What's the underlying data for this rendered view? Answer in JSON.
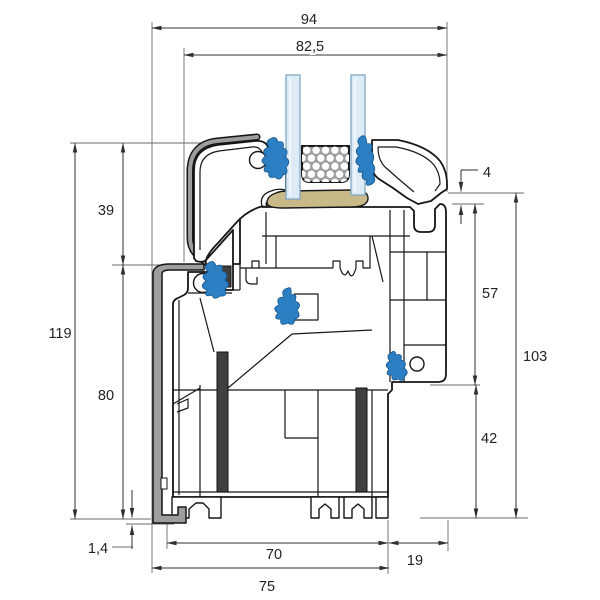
{
  "drawing": {
    "type": "technical-cross-section",
    "subject": "uPVC window frame and sash profile with insulated glazing unit",
    "unit": "mm"
  },
  "dimensions": {
    "d94": {
      "label": "94"
    },
    "d82_5": {
      "label": "82,5"
    },
    "d4": {
      "label": "4"
    },
    "d39": {
      "label": "39"
    },
    "d57": {
      "label": "57"
    },
    "d119": {
      "label": "119"
    },
    "d103": {
      "label": "103"
    },
    "d80": {
      "label": "80"
    },
    "d42": {
      "label": "42"
    },
    "d1_4": {
      "label": "1,4"
    },
    "d70": {
      "label": "70"
    },
    "d19": {
      "label": "19"
    },
    "d75": {
      "label": "75"
    }
  },
  "components": {
    "glass_panes": 2,
    "gaskets": 5,
    "steel_reinforcements": 2,
    "spacer": "honeycomb spacer bar",
    "sealant": "glazing sealant bead"
  },
  "colors": {
    "outline": "#161616",
    "dimension_line": "#2f2f2f",
    "glass": "#dcebf5",
    "glass_edge": "#7fa8c4",
    "gasket_blue": "#2b7fc2",
    "sealant_tan": "#c7ba88",
    "spacer_gray": "#9c9c9c",
    "steel_gray": "#3f3f3f",
    "overlay_gray": "#9e9e9e",
    "background": "#ffffff"
  }
}
